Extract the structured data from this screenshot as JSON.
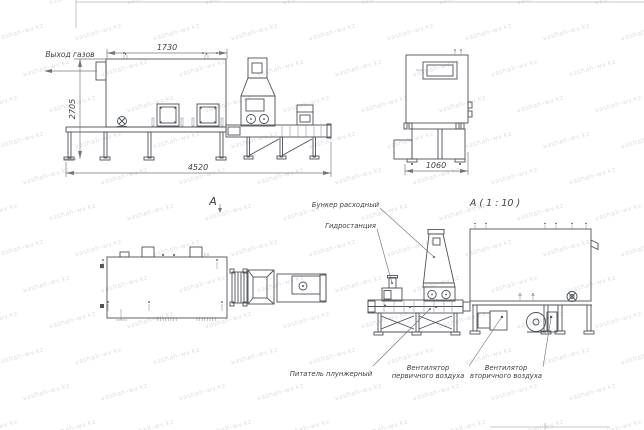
{
  "watermark": {
    "text": "vashah-wv.kz"
  },
  "views": {
    "side": {
      "dim_top": "1730",
      "dim_left": "2705",
      "dim_bottom": "4520",
      "gas_label": "Выход газов"
    },
    "end": {
      "dim_bottom": "1060"
    },
    "plan": {
      "label": "А"
    },
    "detail": {
      "title": "А ( 1 : 10 )",
      "callout_hopper": "Бункер расходный",
      "callout_hydro": "Гидростанция",
      "callout_feeder": "Питатель плунжерный",
      "callout_fan1_l1": "Вентилятор",
      "callout_fan1_l2": "первичного воздуха",
      "callout_fan2_l1": "Вентилятор",
      "callout_fan2_l2": "вторичного воздуха"
    }
  }
}
